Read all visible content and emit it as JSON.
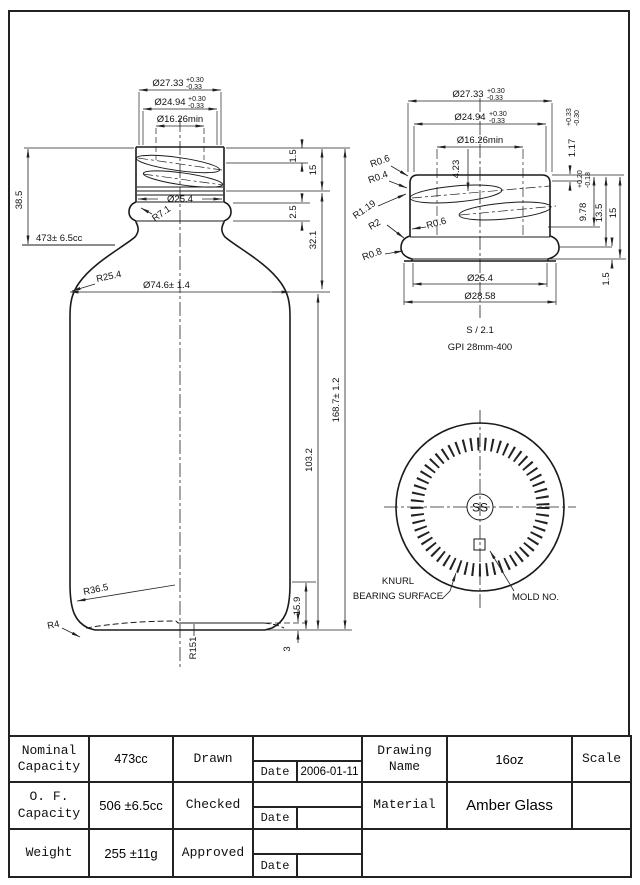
{
  "main_view": {
    "dia_neck_outer": "Ø27.33",
    "dia_neck_outer_tol_plus": "+0.30",
    "dia_neck_outer_tol_minus": "-0.33",
    "dia_thread": "Ø24.94",
    "dia_thread_tol_plus": "+0.30",
    "dia_thread_tol_minus": "-0.33",
    "dia_bore": "Ø16.26min",
    "height_finish": "38.5",
    "fill_level": "473± 6.5cc",
    "dia_neck": "Ø25.4",
    "radius_neck": "R7.1",
    "radius_shoulder": "R25.4",
    "dia_body": "Ø74.6± 1.4",
    "dim_1_5": "1.5",
    "dim_15": "15",
    "dim_2_5": "2.5",
    "dim_32_1": "32.1",
    "height_overall": "168.7± 1.2",
    "dim_103_2": "103.2",
    "dim_15_9": "15.9",
    "dim_3": "3",
    "radius_heel": "R36.5",
    "radius_base": "R4",
    "radius_pushup": "R151"
  },
  "detail_view": {
    "dia_neck_outer": "Ø27.33",
    "dia_neck_outer_tol_plus": "+0.30",
    "dia_neck_outer_tol_minus": "-0.33",
    "dia_thread": "Ø24.94",
    "dia_thread_tol_plus": "+0.30",
    "dia_thread_tol_minus": "-0.33",
    "dia_bore": "Ø16.26min",
    "dim_4_23": "4.23",
    "dim_1_17": "1.17",
    "dim_1_17_tol_plus": "+0.33",
    "dim_1_17_tol_minus": "-0.30",
    "dim_9_78": "9.78",
    "dim_9_78_tol_plus": "+0.20",
    "dim_9_78_tol_minus": "-0.18",
    "dim_13_5": "13.5",
    "dim_15": "15",
    "dim_1_5": "1.5",
    "radius_lip_outer": "R0.6",
    "radius_lip_inner": "R0.4",
    "radius_under_thread": "R1.19",
    "radius_bead_top": "R2",
    "radius_bead_groove": "R0.6",
    "radius_bead_bottom": "R0.8",
    "dia_neck": "Ø25.4",
    "dia_bead": "Ø28.58",
    "scale_note": "S / 2.1",
    "finish_spec": "GPI 28mm-400"
  },
  "bottom_view": {
    "logo": "SS",
    "knurl_label_line1": "KNURL",
    "knurl_label_line2": "BEARING SURFACE",
    "mold_label": "MOLD NO."
  },
  "title_block": {
    "rows": [
      {
        "label_line1": "Nominal",
        "label_line2": "Capacity",
        "value": "473cc",
        "role": "Drawn",
        "date_label": "Date",
        "date_value": "2006-01-11"
      },
      {
        "label_line1": "O. F.",
        "label_line2": "Capacity",
        "value": "506 ±6.5cc",
        "role": "Checked",
        "date_label": "Date",
        "date_value": ""
      },
      {
        "label_line1": "Weight",
        "label_line2": "",
        "value": "255 ±11g",
        "role": "Approved",
        "date_label": "Date",
        "date_value": ""
      }
    ],
    "drawing_name_label_line1": "Drawing",
    "drawing_name_label_line2": "Name",
    "drawing_name_value": "16oz",
    "scale_label": "Scale",
    "material_label": "Material",
    "material_value": "Amber Glass"
  }
}
